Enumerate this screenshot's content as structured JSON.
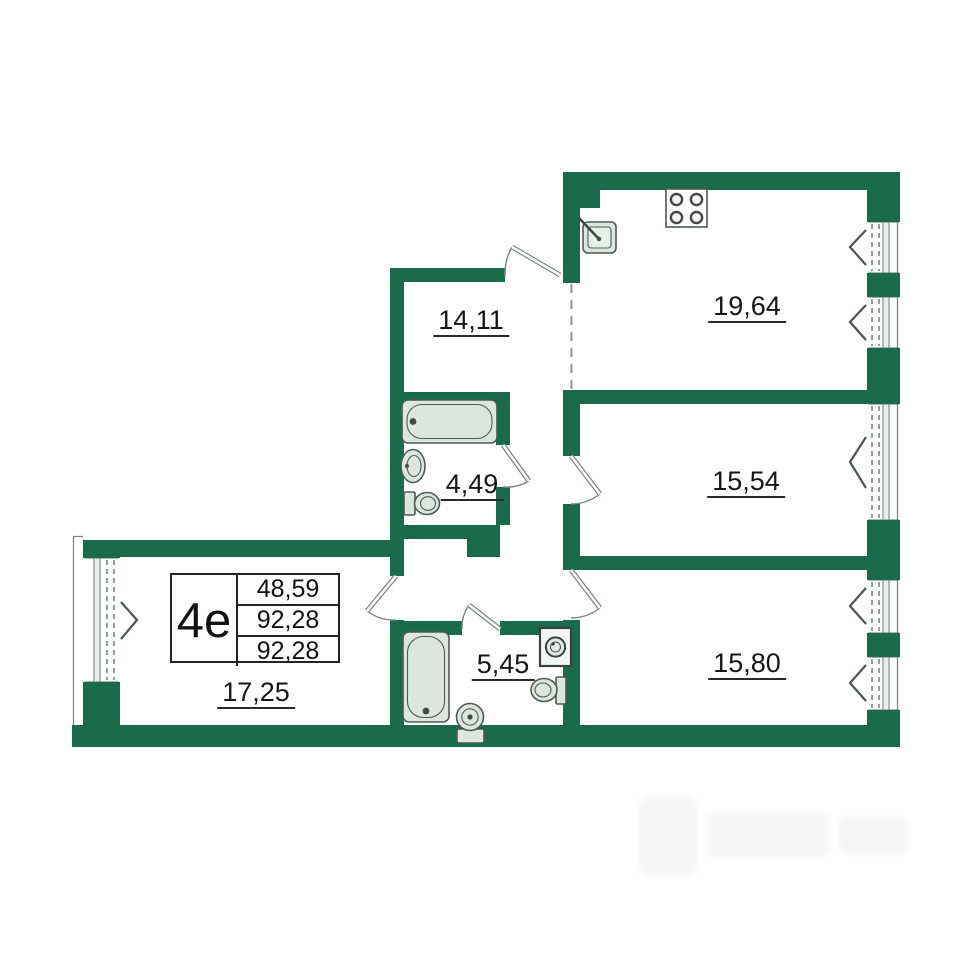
{
  "apartment_card": {
    "type_label": "4е",
    "values": [
      "48,59",
      "92,28",
      "92,28"
    ]
  },
  "rooms": {
    "hallway": {
      "area": "14,11"
    },
    "kitchen_living": {
      "area": "19,64"
    },
    "bathroom_small": {
      "area": "4,49"
    },
    "room_upper": {
      "area": "15,54"
    },
    "bathroom_large": {
      "area": "5,45"
    },
    "room_lower": {
      "area": "15,80"
    },
    "room_left": {
      "area": "17,25"
    }
  },
  "colors": {
    "wall": "#1a6b4c",
    "line": "#7c8783",
    "fixfill": "#dde5e0",
    "fixline": "#4f5954",
    "text": "#161616"
  }
}
